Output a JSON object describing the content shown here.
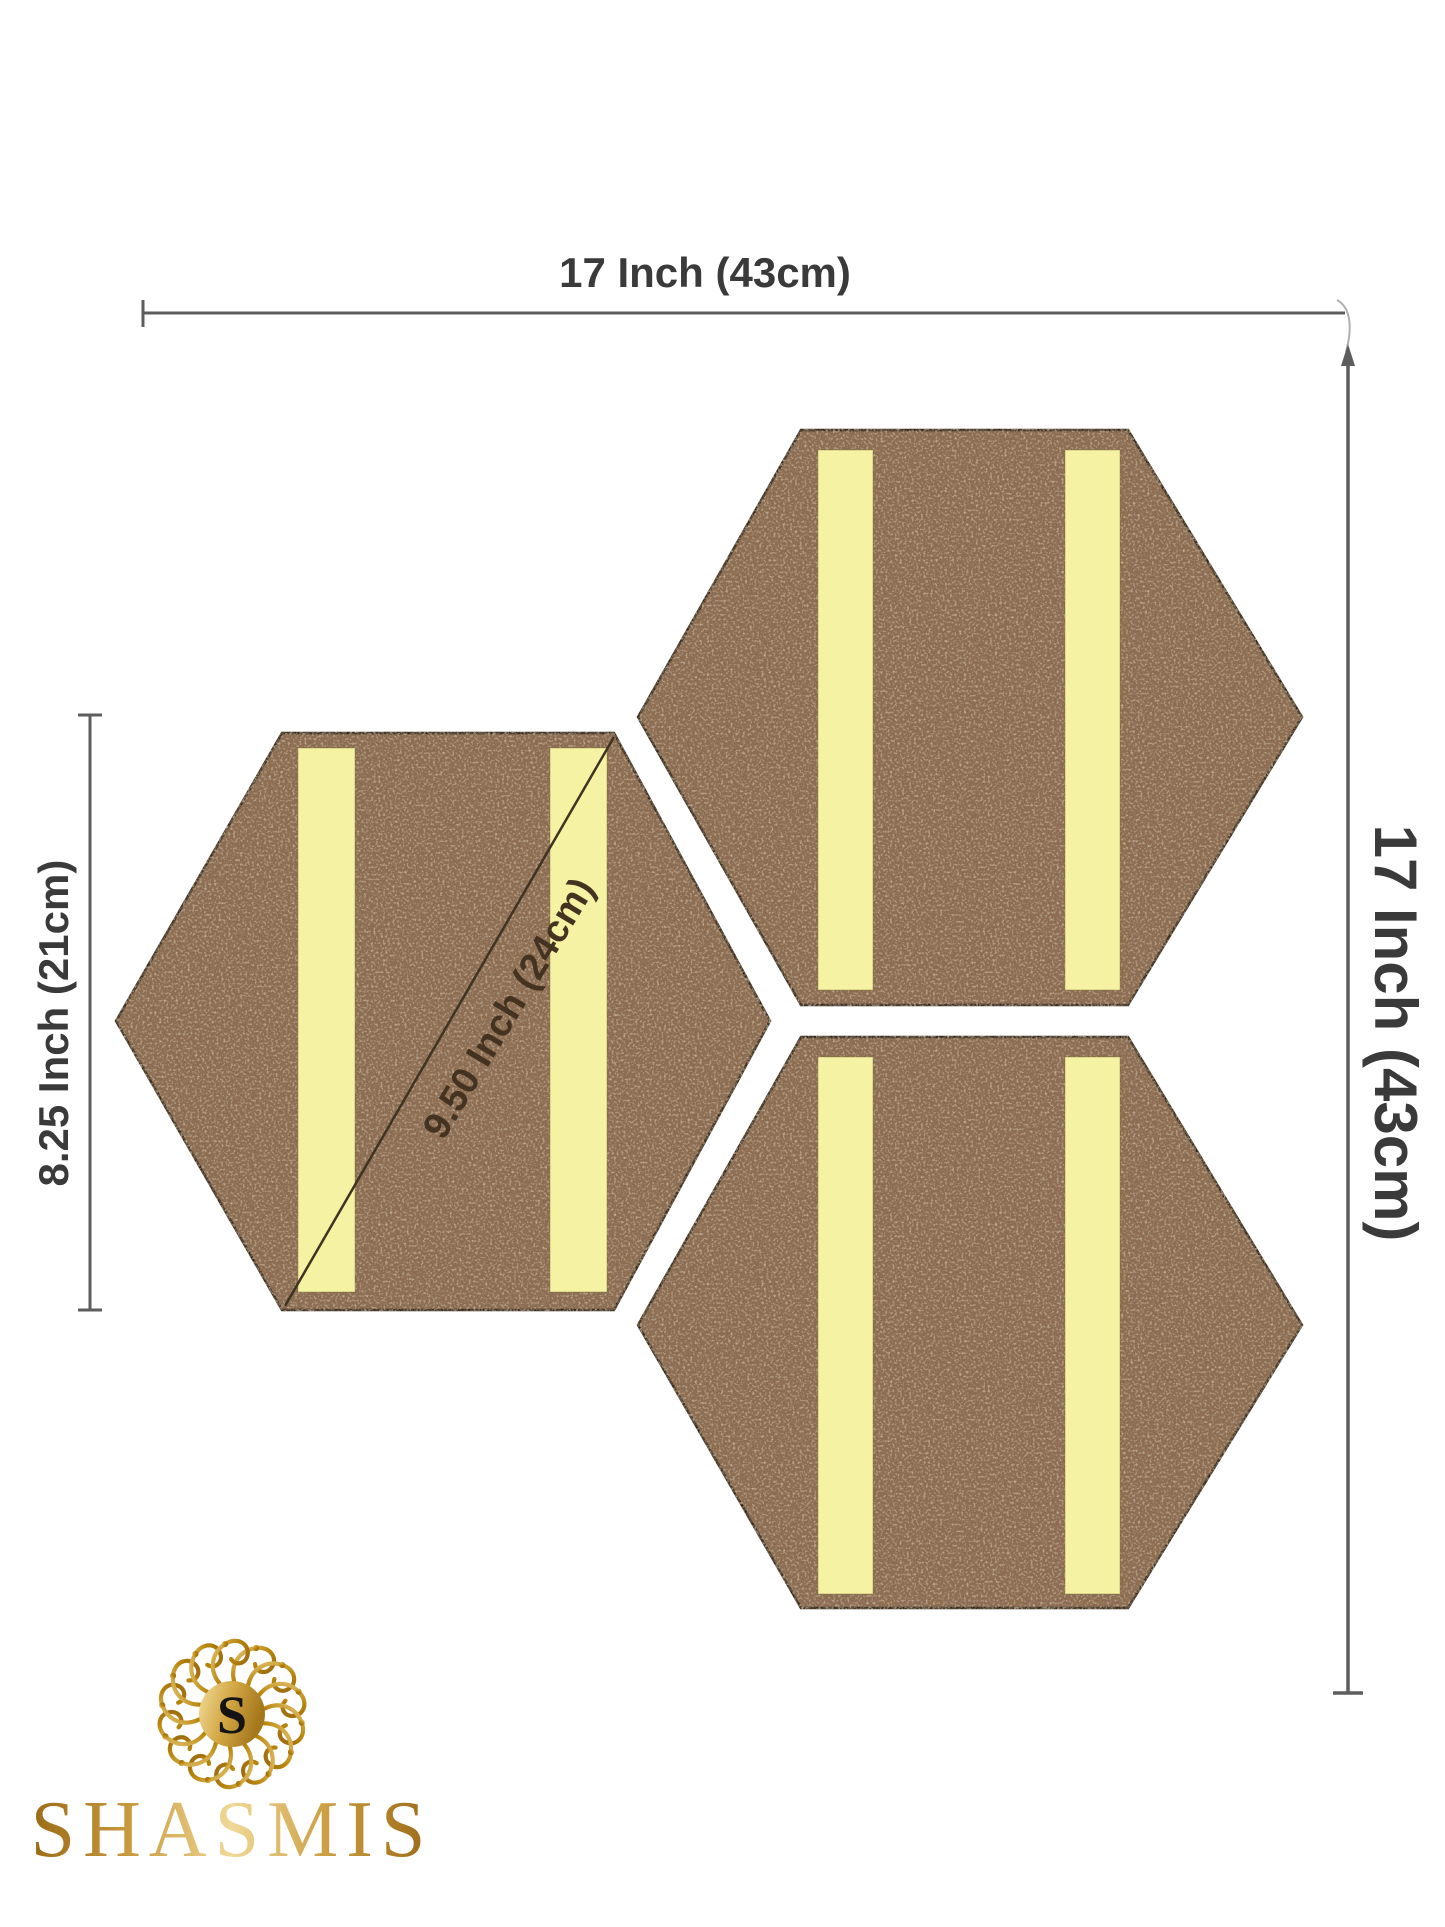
{
  "dimensions": {
    "overall_width_label": "17 Inch (43cm)",
    "overall_height_label": "17 Inch (43cm)",
    "tile_height_label": "8.25 Inch (21cm)",
    "tile_diagonal_label": "9.50 Inch (24cm)"
  },
  "tiles": {
    "count": 3,
    "strips_per_tile": 2,
    "cork_color": "#8e6c50",
    "strip_color": "#f5f2a3",
    "outline_color": "#2e2118"
  },
  "annotation": {
    "line_color": "#5d5d5d",
    "diagonal_line_color": "#3f3322"
  },
  "brand": {
    "name": "SHASMIS",
    "monogram": "S",
    "gold_dark": "#9a6a16",
    "gold_light": "#f0d896"
  }
}
